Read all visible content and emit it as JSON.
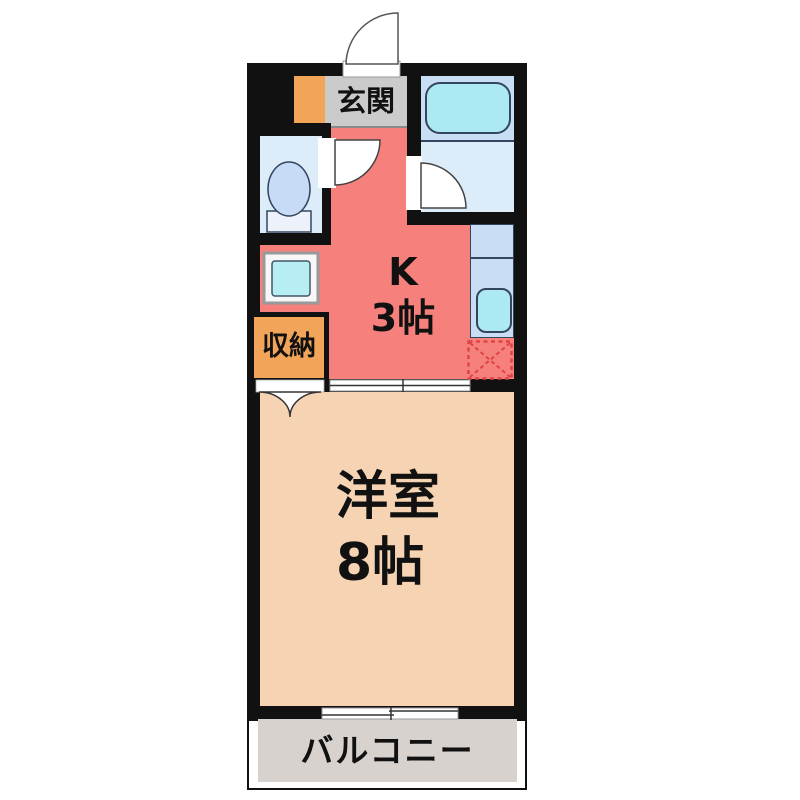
{
  "floorplan": {
    "type": "japanese-apartment-floor-plan",
    "rooms": {
      "entrance": {
        "label": "玄関"
      },
      "kitchen": {
        "line1": "K",
        "line2": "3帖"
      },
      "storage": {
        "label": "収納"
      },
      "main_room": {
        "line1": "洋室",
        "line2": "8帖"
      },
      "balcony": {
        "label": "バルコニー"
      }
    },
    "fixtures": [
      "entrance-door-arc",
      "toilet-icon",
      "toilet-door-arc",
      "bathtub-icon",
      "bathroom-door-arc",
      "washing-machine-pan-icon",
      "kitchen-sink-icon",
      "refrigerator-space",
      "closet-folding-door",
      "sliding-door",
      "balcony-window"
    ],
    "colors": {
      "wall": "#111111",
      "kitchen": "#f5807c",
      "main_room": "#f6d3b2",
      "entrance": "#cbcbcb",
      "storage": "#f2a459",
      "shoe_cabinet": "#f2a459",
      "toilet_room": "#ddecf9",
      "toilet": "#c7dbf7",
      "bathroom_tub_zone": "#c7def5",
      "bathroom_floor": "#ddecf9",
      "bathtub": "#ace9f3",
      "counter": "#c9def5",
      "sink": "#ace9f3",
      "washing_pan": "#b6eef3",
      "balcony": "#d7d2ce",
      "fridge_dashed": "#e04343",
      "text": "#111111"
    }
  }
}
